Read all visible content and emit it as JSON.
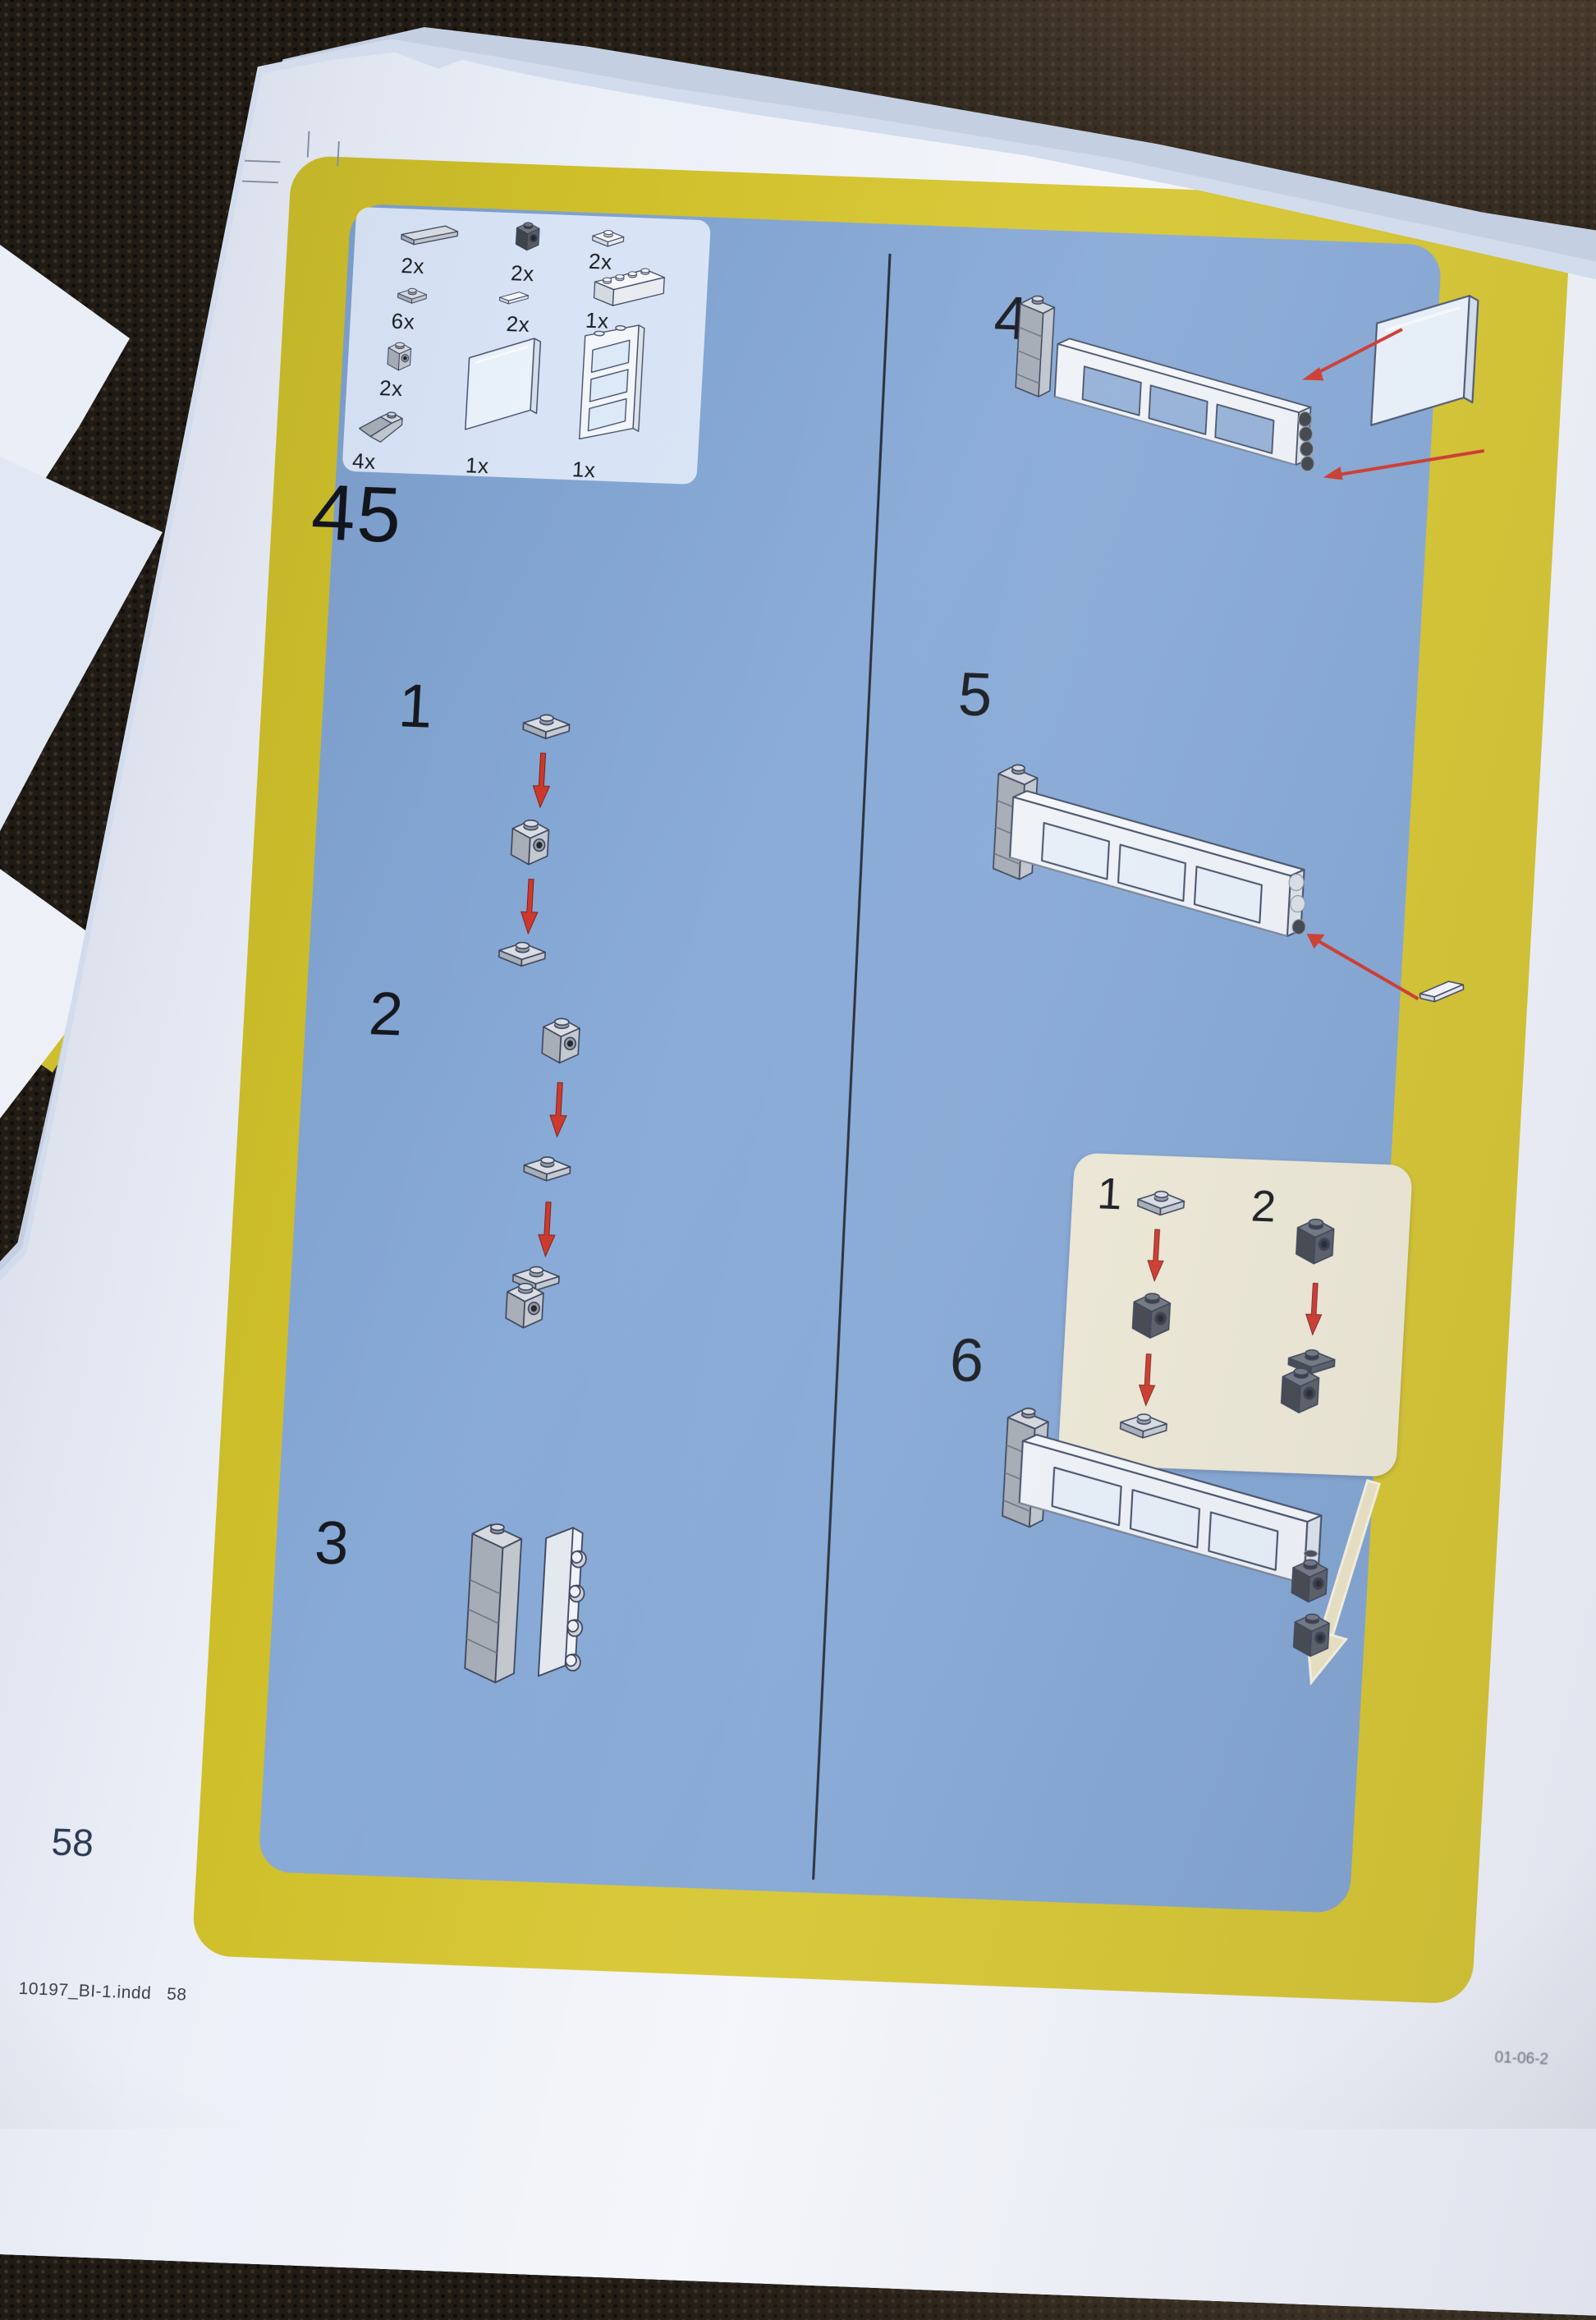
{
  "colors": {
    "page_blue": "#84a6d3",
    "border_yellow": "#d3c52e",
    "parts_panel": "#e7f0fb",
    "inset_cream": "#ece7d4",
    "arrow_red": "#cc372a",
    "arrow_cream": "#e9e2c2",
    "desk_dark": "#211b15"
  },
  "page": {
    "step_number": "45",
    "page_number": "58",
    "footer_file": "10197_BI-1.indd   58",
    "footer_date_partial": "01-06-2",
    "parts_box": {
      "items": [
        {
          "part": "tile-1x4-gray",
          "qty": "2x"
        },
        {
          "part": "brick-1x1-side-stud-dark",
          "qty": "2x"
        },
        {
          "part": "plate-1x2-one-stud-white",
          "qty": "2x"
        },
        {
          "part": "plate-1x2-one-stud-gray",
          "qty": "6x"
        },
        {
          "part": "tile-1x2-white",
          "qty": "2x"
        },
        {
          "part": "brick-1x4-white",
          "qty": "1x"
        },
        {
          "part": "brick-1x1-side-stud-gray",
          "qty": "2x"
        },
        {
          "part": "glass-panel-1x4x3",
          "qty": "1x"
        },
        {
          "part": "window-frame-1x4x3",
          "qty": "1x"
        },
        {
          "part": "slope-brick-45-gray",
          "qty": "4x"
        }
      ]
    },
    "steps": [
      {
        "label": "1"
      },
      {
        "label": "2"
      },
      {
        "label": "3"
      },
      {
        "label": "4"
      },
      {
        "label": "5"
      },
      {
        "label": "6"
      }
    ],
    "inset": {
      "sub_steps": [
        {
          "label": "1"
        },
        {
          "label": "2"
        }
      ]
    }
  }
}
